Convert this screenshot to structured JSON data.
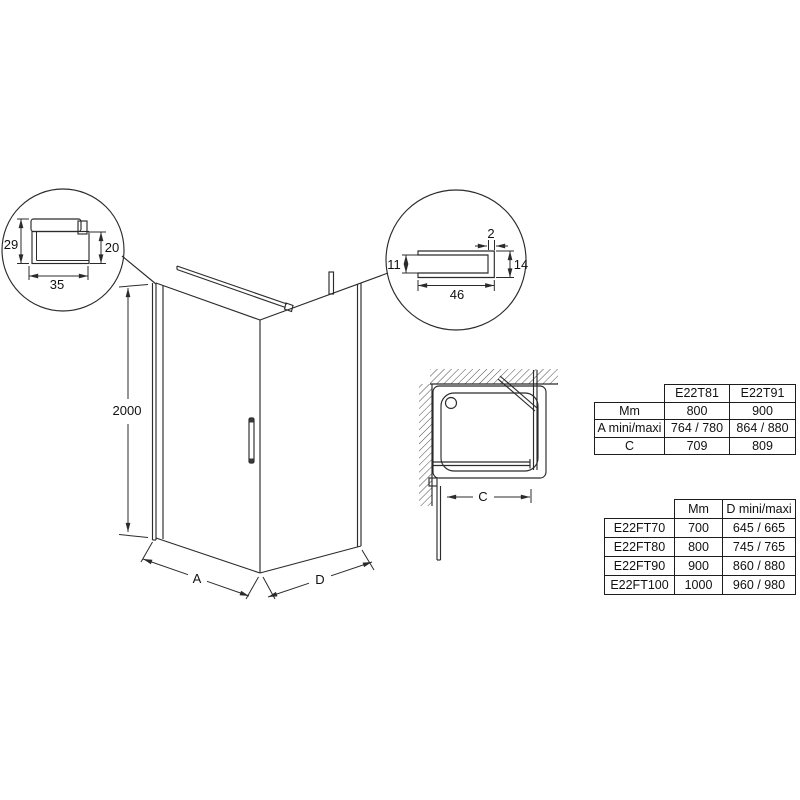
{
  "page": {
    "background": "#ffffff",
    "line_color": "#2b2b2b"
  },
  "detail_wall_profile": {
    "description": "magnified cross-section of wall mounting profile",
    "dims": {
      "height": "29",
      "glass_height": "20",
      "width": "35"
    }
  },
  "detail_channel_profile": {
    "description": "magnified cross-section of glass channel profile",
    "dims": {
      "thickness": "2",
      "opening": "11",
      "height": "14",
      "width": "46"
    }
  },
  "elevation": {
    "description": "isometric view of corner shower enclosure",
    "dims": {
      "height": "2000",
      "front_width": "A",
      "side_width": "D"
    }
  },
  "plan": {
    "description": "top view with shower tray, walls and open door",
    "dims": {
      "clear_width": "C"
    }
  },
  "tables": {
    "models": {
      "columns": [
        "E22T81",
        "E22T91"
      ],
      "rows": [
        {
          "label": "Mm",
          "values": [
            "800",
            "900"
          ]
        },
        {
          "label": "A mini/maxi",
          "values": [
            "764 / 780",
            "864 / 880"
          ]
        },
        {
          "label": "C",
          "values": [
            "709",
            "809"
          ]
        }
      ]
    },
    "side_panels": {
      "columns": [
        "Mm",
        "D mini/maxi"
      ],
      "rows": [
        {
          "label": "E22FT70",
          "values": [
            "700",
            "645 / 665"
          ]
        },
        {
          "label": "E22FT80",
          "values": [
            "800",
            "745 / 765"
          ]
        },
        {
          "label": "E22FT90",
          "values": [
            "900",
            "860 / 880"
          ]
        },
        {
          "label": "E22FT100",
          "values": [
            "1000",
            "960 / 980"
          ]
        }
      ]
    }
  }
}
